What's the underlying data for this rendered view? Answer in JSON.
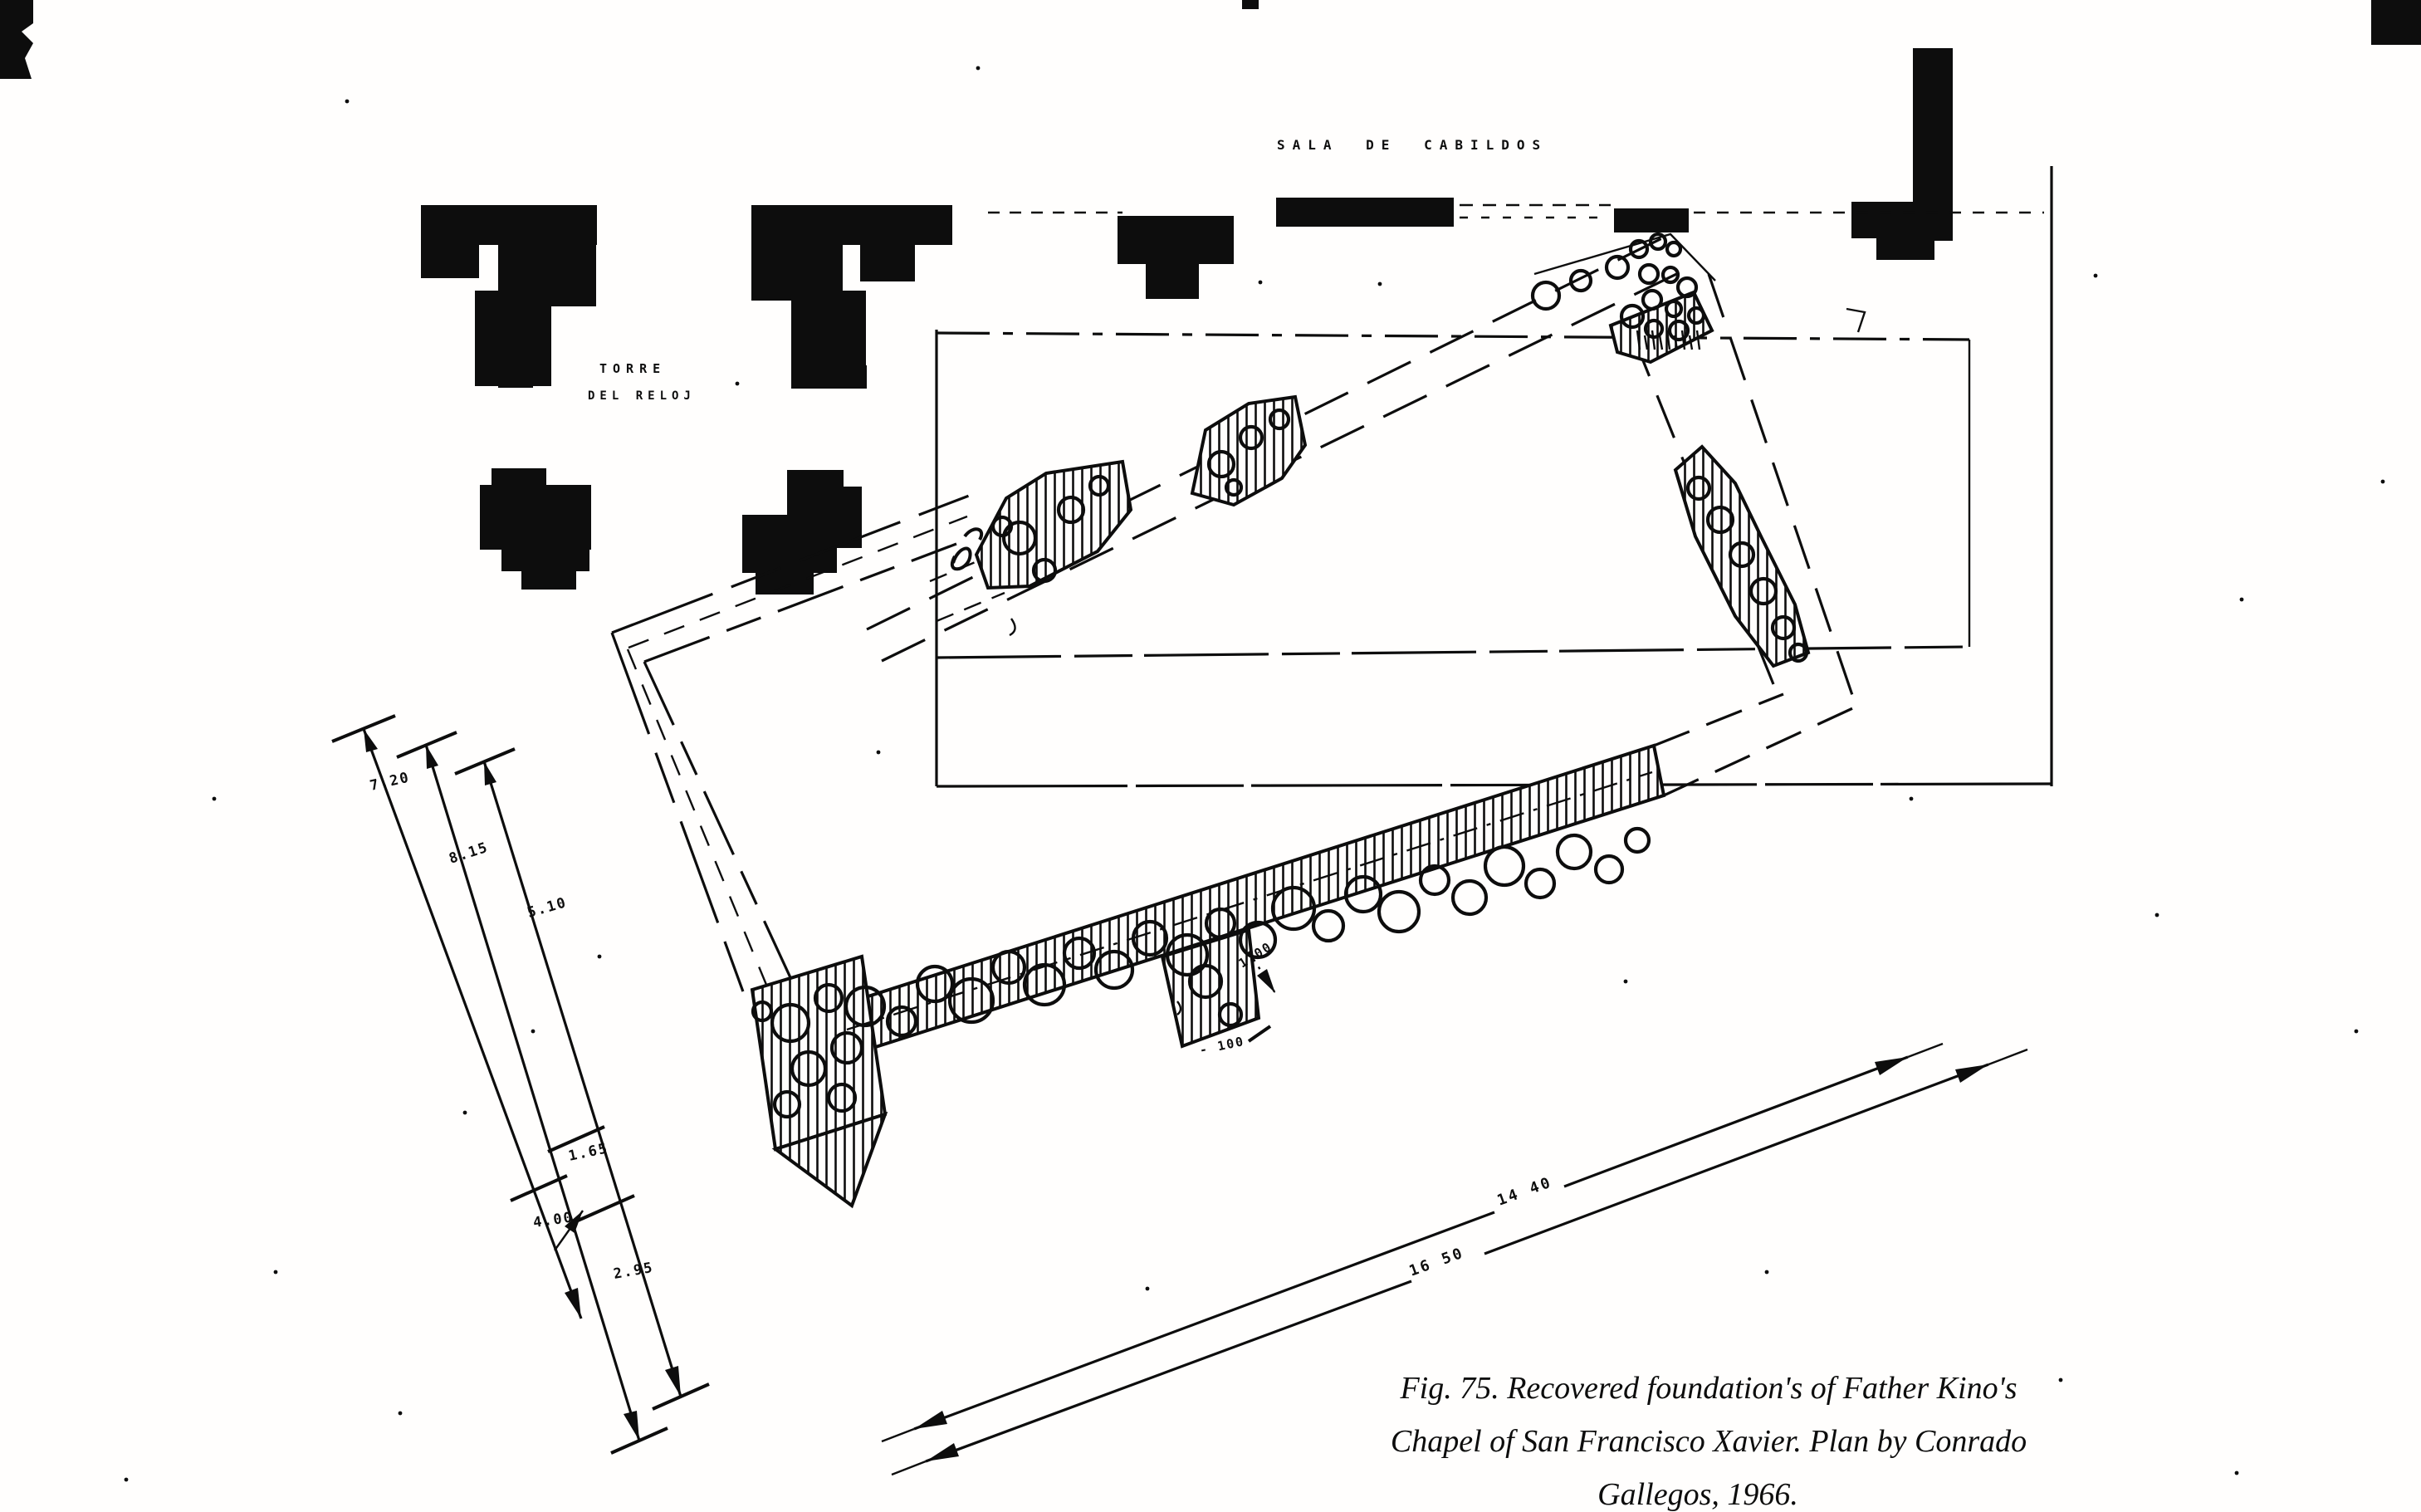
{
  "plan": {
    "sala_label": "SALA DE CABILDOS",
    "torre_label_line1": "TORRE",
    "torre_label_line2": "DEL RELOJ"
  },
  "dimensions": {
    "fan": {
      "d1": "7.20",
      "d2": "8.15",
      "d3": "5.10",
      "d4": "1.65",
      "d5": "4.00",
      "d6": "2.95"
    },
    "bottom": {
      "upper": "14 40",
      "lower": "16 50"
    },
    "wall": {
      "a": "1 00",
      "b": "- 100"
    }
  },
  "caption": {
    "line1": "Fig. 75. Recovered foundation's of Father Kino's",
    "line2": "Chapel of San Francisco Xavier. Plan by Conrado",
    "line3": "Gallegos, 1966."
  }
}
